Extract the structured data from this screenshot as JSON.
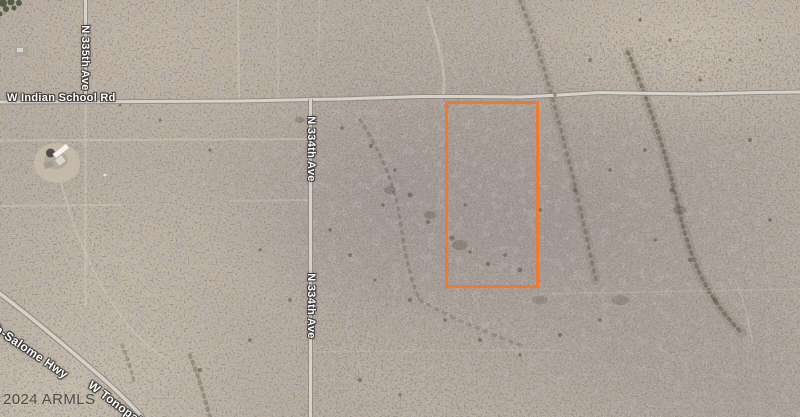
{
  "map": {
    "view": "satellite",
    "labels": {
      "indian_school": "W Indian School Rd",
      "n335": "N 335th Ave",
      "n334_upper": "N 334th Ave",
      "n334_lower": "N 334th Ave",
      "salome": "ah-Salome Hwy",
      "tonopah": "W Tonopah"
    },
    "attribution": "2024 ARMLS",
    "parcel_outline": {
      "color": "#ED7A2F",
      "x": 446,
      "y": 102,
      "width": 92,
      "height": 185
    },
    "terrain_colors": {
      "base": "#b2a79b",
      "light_tan": "#cdc2b0",
      "purple_gray": "#978b8e",
      "road_fill": "#d6d2c9",
      "road_casing": "#89847a"
    }
  }
}
